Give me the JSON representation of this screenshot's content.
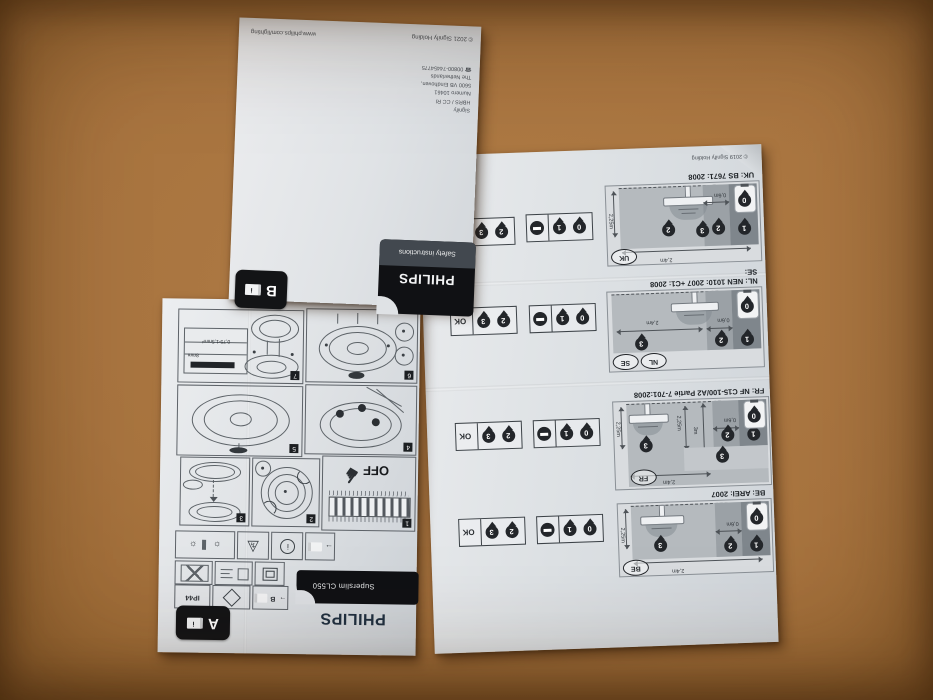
{
  "safety_leaflet": {
    "brand": "PHILIPS",
    "tab_label": "Safety instructions",
    "badge": "B",
    "website": "www.philips.com/lighting",
    "copyright": "© 2021 Signify Holding",
    "address_lines": [
      "Signify",
      "HBRS / CC RI",
      "Numero 10461",
      "5600 VB Eindhoven,",
      "The Netherlands",
      "00800-74454775"
    ]
  },
  "manual_leaflet": {
    "brand": "PHILIPS",
    "product": "Superslim CL550",
    "badge": "A",
    "off_label": "OFF",
    "ip_rating": "IP44",
    "wire_spec": "0,75-1,5mm²",
    "strip_length": "8mm",
    "steps": [
      "1",
      "2",
      "3",
      "4",
      "5",
      "6",
      "7"
    ]
  },
  "zones_sheet": {
    "copyright": "© 2019 Signify Holding",
    "ok_label": "OK",
    "zone_labels": {
      "z0": "0",
      "z1": "1",
      "z2": "2",
      "z3": "3"
    },
    "sections": [
      {
        "id": "uk",
        "heading": "UK: BS 7671: 2008",
        "countries": [
          "UK"
        ],
        "width": "2,4m",
        "height": "2,25m",
        "gap": "0,6m"
      },
      {
        "id": "nl-se",
        "subheading": "SE:",
        "heading": "NL: NEN 1010: 2007 +C1: 2008",
        "countries": [
          "SE",
          "NL"
        ],
        "width": "2,4m",
        "gap": "0,6m"
      },
      {
        "id": "fr",
        "heading": "FR: NF C15-100/A2 Partie 7-701:2008",
        "countries": [
          "FR"
        ],
        "width": "2,4m",
        "height": "2,25m",
        "height2": "2,25m",
        "height3": "3m",
        "gap": "0,6m"
      },
      {
        "id": "be",
        "heading": "BE: AREI: 2007",
        "countries": [
          "BE"
        ],
        "width": "2,4m",
        "height": "2,25m",
        "gap": "0,6m"
      }
    ]
  }
}
